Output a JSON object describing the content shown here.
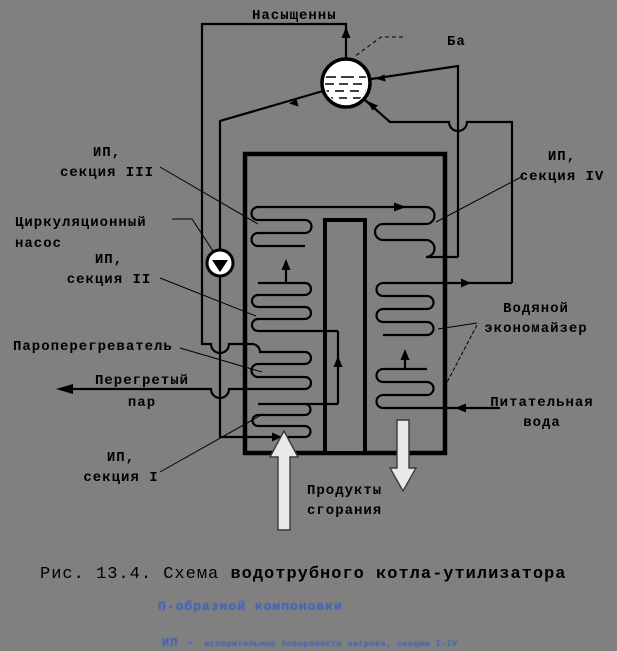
{
  "colors": {
    "background": "#808080",
    "line": "#000000",
    "vessel_fill": "#ffffff",
    "gas_arrow_fill": "#e9e9e9",
    "note_blue": "#3a5fc0"
  },
  "labels": {
    "saturated_steam": "Насыщенны",
    "drum": "Ба",
    "ip3_line1": "ИП,",
    "ip3_line2": "секция III",
    "pump_line1": "Циркуляционный",
    "pump_line2": "насос",
    "ip2_line1": "ИП,",
    "ip2_line2": "секция II",
    "ip4_line1": "ИП,",
    "ip4_line2": "секция IV",
    "eco_line1": "Водяной",
    "eco_line2": "экономайзер",
    "superheater": "Пароперегреватель",
    "steam_out_line1": "Перегретый",
    "steam_out_line2": "пар",
    "feed_line1": "Питательная",
    "feed_line2": "вода",
    "ip1_line1": "ИП,",
    "ip1_line2": "секция I",
    "gas_line1": "Продукты",
    "gas_line2": "сгорания"
  },
  "caption": {
    "prefix": "Рис. 13.4. Схема ",
    "bold": "водотрубного котла-утилизатора"
  },
  "notes": {
    "line1": "П-образной компоновки",
    "line2_term": "ИП –",
    "line2_rest": "испарительные поверхности нагрева, секции I–IV"
  }
}
